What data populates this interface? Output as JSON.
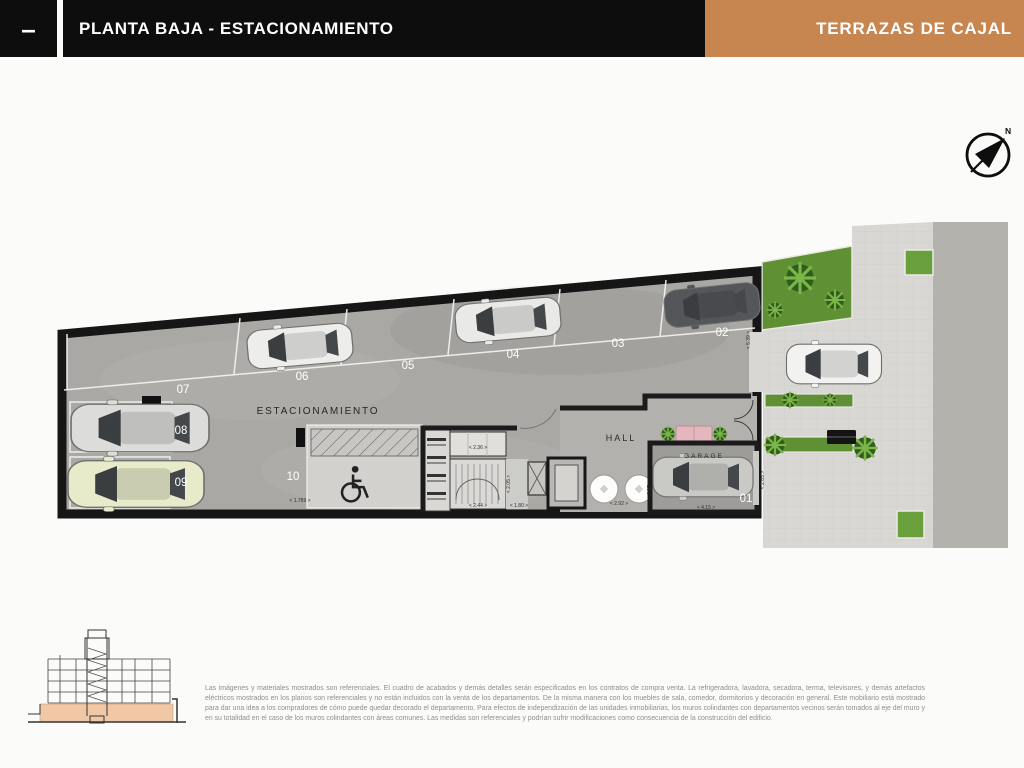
{
  "header": {
    "window_dash": "–",
    "title": "PLANTA BAJA - ESTACIONAMIENTO",
    "brand": "TERRAZAS DE CAJAL"
  },
  "compass": {
    "north": "N"
  },
  "plan": {
    "labels": {
      "parking": "ESTACIONAMIENTO",
      "hall": "HALL",
      "garage": "GARAGE"
    },
    "stalls": [
      {
        "number": "01",
        "occupied": true,
        "car_color": "silver"
      },
      {
        "number": "02",
        "occupied": true,
        "car_color": "dark-gray"
      },
      {
        "number": "03",
        "occupied": false,
        "car_color": null
      },
      {
        "number": "04",
        "occupied": true,
        "car_color": "white"
      },
      {
        "number": "05",
        "occupied": false,
        "car_color": null
      },
      {
        "number": "06",
        "occupied": true,
        "car_color": "white"
      },
      {
        "number": "07",
        "occupied": false,
        "car_color": null
      },
      {
        "number": "08",
        "occupied": true,
        "car_color": "silver"
      },
      {
        "number": "09",
        "occupied": true,
        "car_color": "pale-yellow"
      },
      {
        "number": "10",
        "occupied": false,
        "car_color": null,
        "accessible": true
      }
    ],
    "dimensions": {
      "spot10_width": "< 1.789 >",
      "room_236": "< 2.36 >",
      "stair_244": "< 2.44 >",
      "stair_205": "< 2.05 >",
      "corridor_180": "< 1.80 >",
      "hall_292": "< 2.92 >",
      "hall_297": "2.97",
      "ramp_539": "< 5.39 >",
      "garage_415": "< 4.15 >",
      "garage_265": "< 2.65 >"
    }
  },
  "colors": {
    "accent": "#C7854F",
    "header_black": "#0D0D0D",
    "wall": "#1A1A1A",
    "concrete": "#A9A8A4",
    "greenery": "#5F9134",
    "section_ground": "#F0C8A6"
  },
  "footer": {
    "disclaimer": "Las imágenes y materiales mostrados son referenciales. El cuadro de acabados y demás detalles serán especificados en los contratos de compra venta. La refrigeradora, lavadora, secadora, terma, televisores, y demás artefactos eléctricos mostrados en los planos son referenciales y no están incluidos con la venta de los departamentos. De la misma manera con los muebles de sala, comedor, dormitorios y decoración en general. Este mobiliario está mostrado para dar una idea a los compradores de cómo puede quedar decorado el departamento. Para efectos de independización de las unidades inmobiliarias, los muros colindantes con departamentos vecinos serán tomados al eje del muro y en su totalidad en el caso de los muros colindantes con áreas comunes. Las medidas son referenciales y podrían sufrir modificaciones como consecuencia de la construcción del edificio."
  }
}
